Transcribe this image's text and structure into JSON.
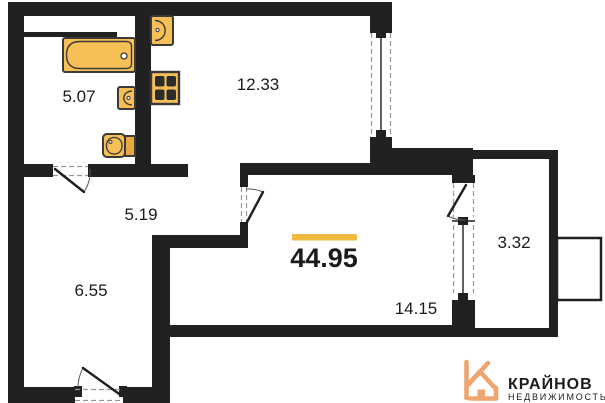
{
  "plan": {
    "total_area": "44.95",
    "rooms": [
      {
        "name": "bathroom",
        "area": "5.07"
      },
      {
        "name": "kitchen",
        "area": "12.33"
      },
      {
        "name": "hallway",
        "area": "5.19"
      },
      {
        "name": "room",
        "area": "6.55"
      },
      {
        "name": "living-room",
        "area": "14.15"
      },
      {
        "name": "balcony",
        "area": "3.32"
      }
    ]
  },
  "branding": {
    "name": "КРАЙНОВ",
    "subtitle": "НЕДВИЖИМОСТЬ"
  },
  "colors": {
    "wall": "#212121",
    "fixture": "#F7C057",
    "fixture_alt": "#E9A93F",
    "burner": "#2B2B2B",
    "accent_bar": "#F0B93F",
    "brand": "#EC9C55",
    "brand_light": "#F2C8A2",
    "brand_icon": "#EDA670"
  }
}
